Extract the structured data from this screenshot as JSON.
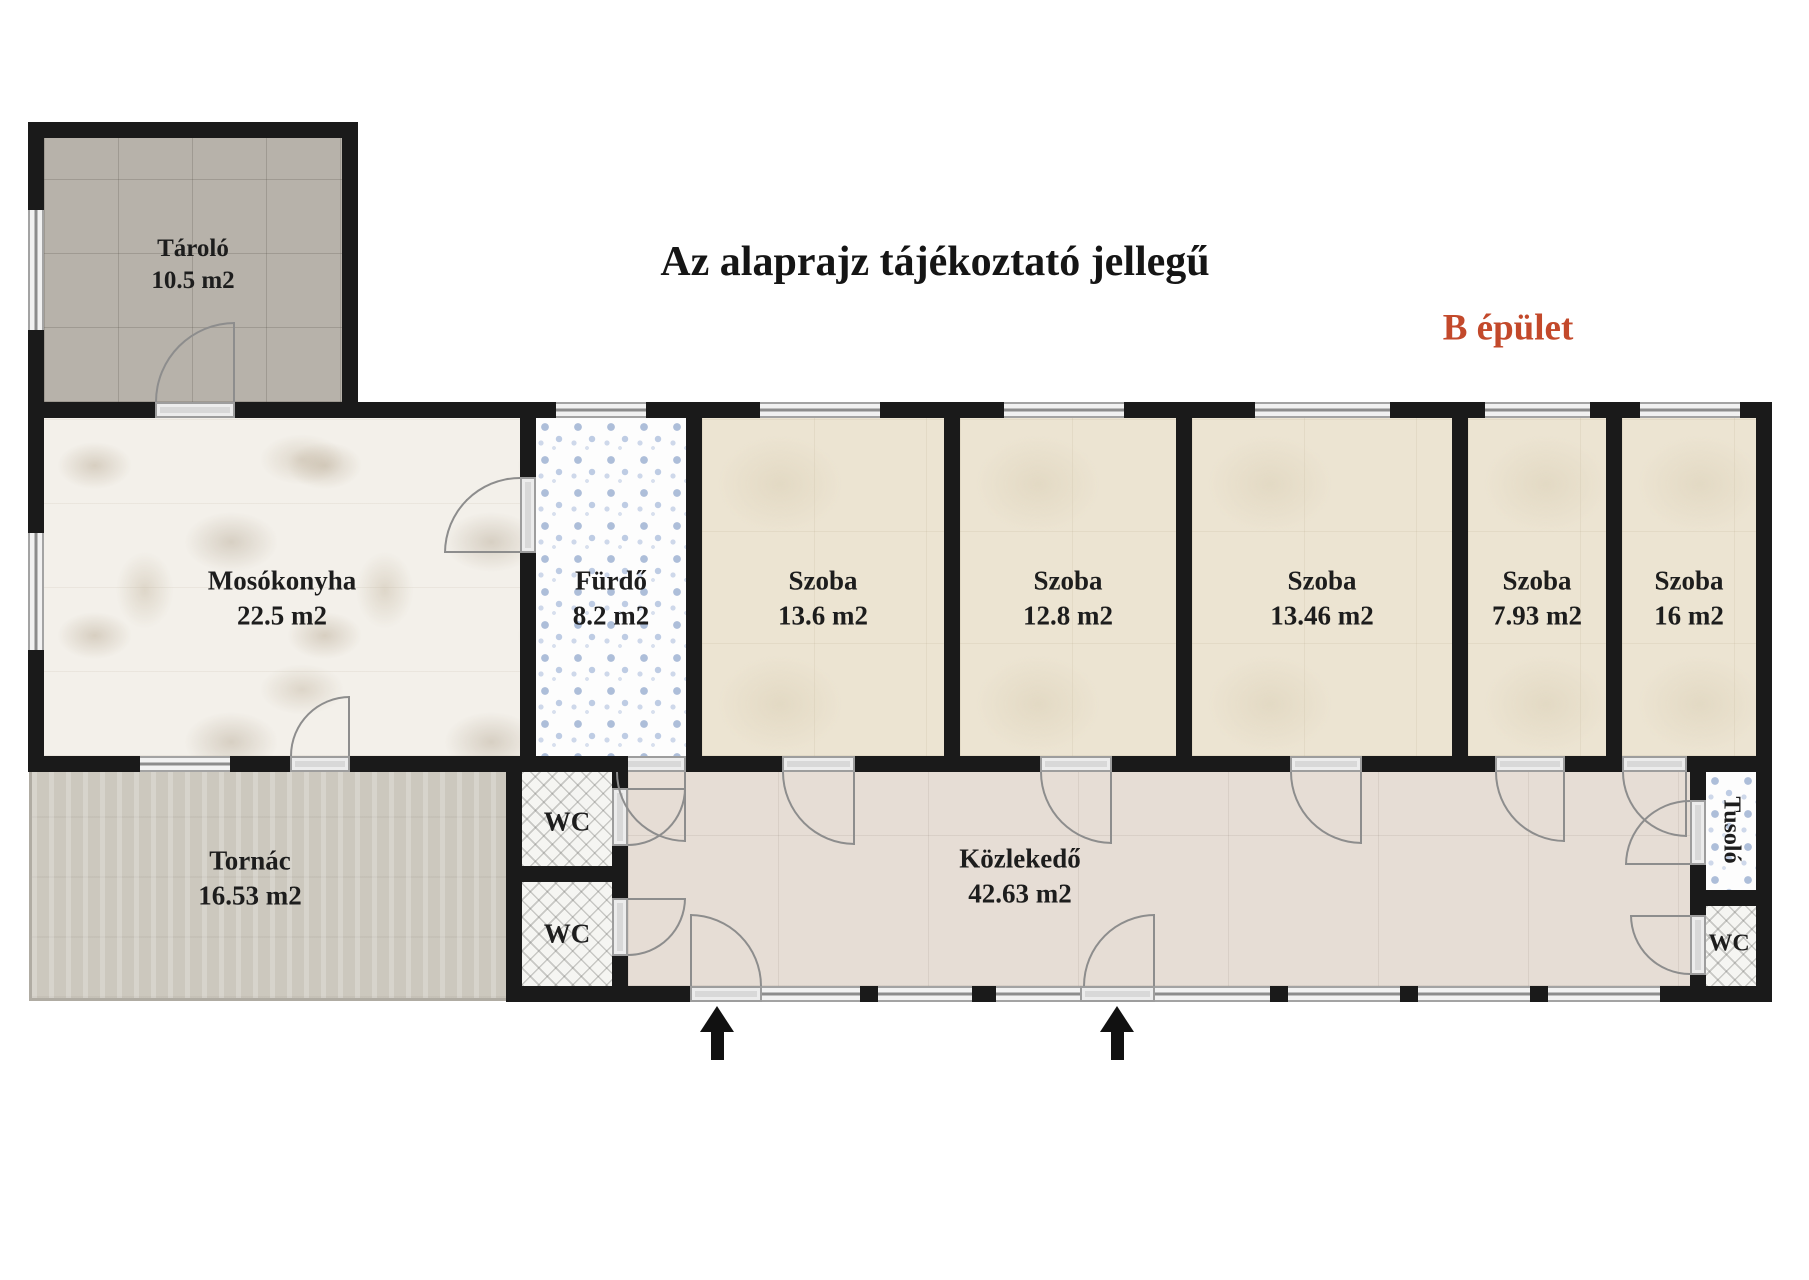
{
  "title": "Az alaprajz tájékoztató jellegű",
  "building": {
    "label": "B épület",
    "label_color": "#c3492b"
  },
  "rooms": {
    "tarolo": {
      "name": "Tároló",
      "area": "10.5 m2"
    },
    "mosokonyha": {
      "name": "Mosókonyha",
      "area": "22.5 m2"
    },
    "furdo": {
      "name": "Fürdő",
      "area": "8.2 m2"
    },
    "szoba1": {
      "name": "Szoba",
      "area": "13.6 m2"
    },
    "szoba2": {
      "name": "Szoba",
      "area": "12.8 m2"
    },
    "szoba3": {
      "name": "Szoba",
      "area": "13.46 m2"
    },
    "szoba4": {
      "name": "Szoba",
      "area": "7.93 m2"
    },
    "szoba5": {
      "name": "Szoba",
      "area": "16 m2"
    },
    "tornac": {
      "name": "Tornác",
      "area": "16.53 m2"
    },
    "wc_top": {
      "name": "WC"
    },
    "wc_bottom": {
      "name": "WC"
    },
    "kozlekedo": {
      "name": "Közlekedő",
      "area": "42.63 m2"
    },
    "tusolo": {
      "name": "Tusoló"
    },
    "wc_right": {
      "name": "WC"
    }
  },
  "icons": {
    "entrance_arrow": "up-arrow"
  }
}
